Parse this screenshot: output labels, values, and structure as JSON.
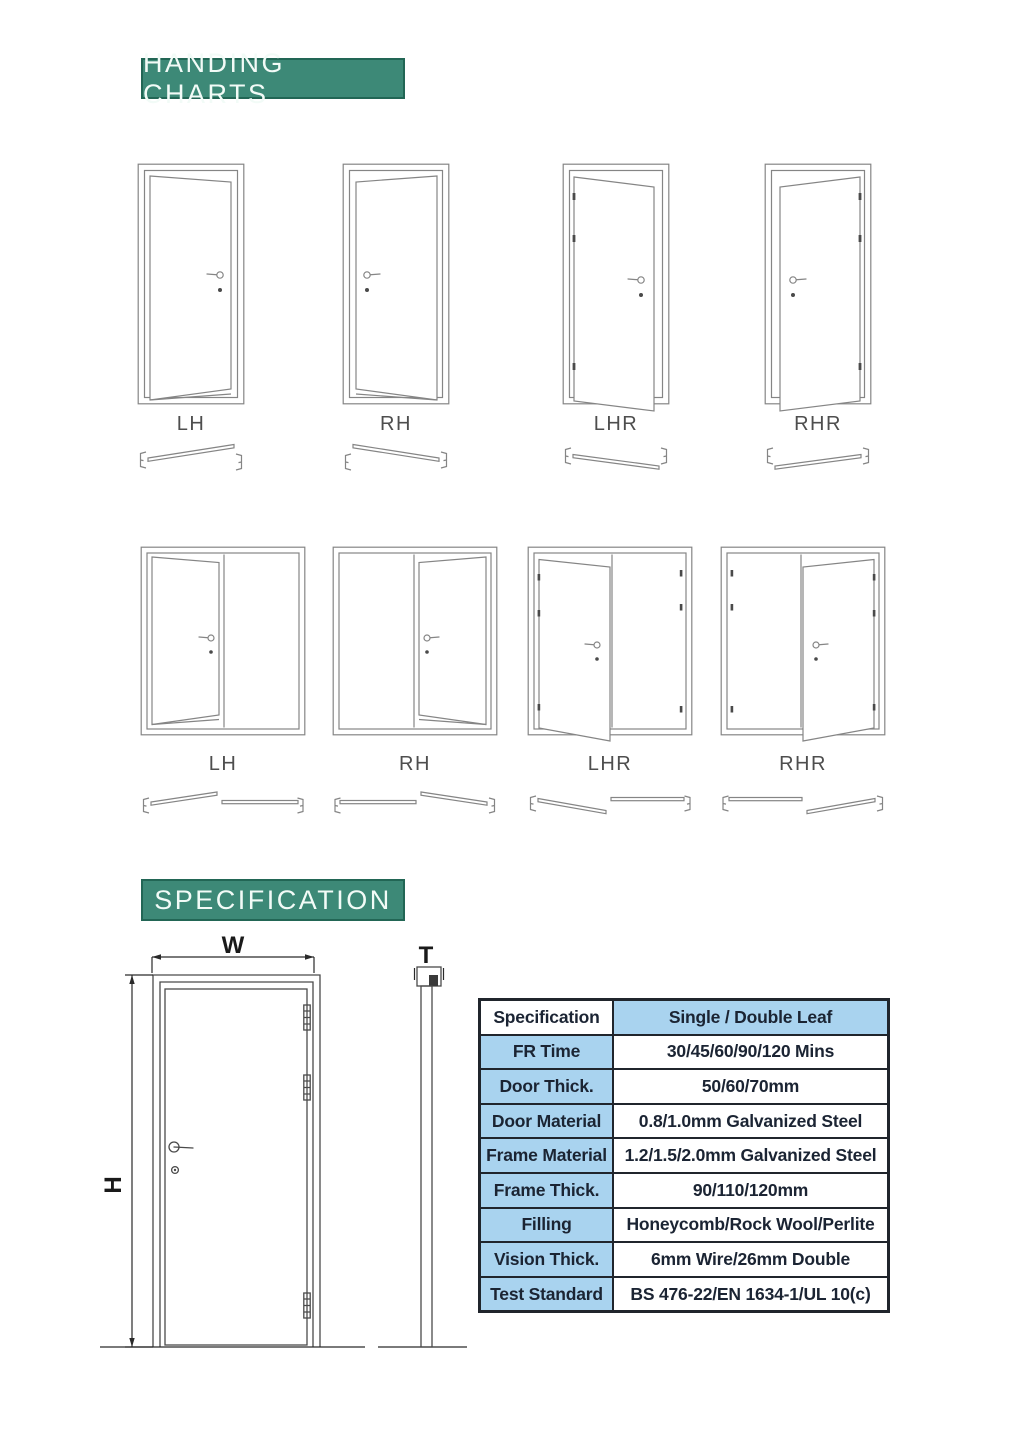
{
  "colors": {
    "banner_bg": "#3d8977",
    "banner_border": "#226655",
    "banner_text": "#f2fbf7",
    "table_blue": "#a9d3ef",
    "table_border": "#20252c",
    "table_text": "#1b2433",
    "line": "#858585",
    "line_dark": "#4a4a4a",
    "label_text": "#4e4e4e",
    "dim_text": "#1a1a1a"
  },
  "handing": {
    "title": "HANDING CHARTS",
    "single_doors": [
      {
        "label": "LH"
      },
      {
        "label": "RH"
      },
      {
        "label": "LHR"
      },
      {
        "label": "RHR"
      }
    ],
    "double_doors": [
      {
        "label": "LH"
      },
      {
        "label": "RH"
      },
      {
        "label": "LHR"
      },
      {
        "label": "RHR"
      }
    ]
  },
  "specification": {
    "title": "SPECIFICATION",
    "dimension_labels": {
      "width": "W",
      "height": "H",
      "thickness": "T"
    },
    "table": {
      "rows": [
        {
          "label": "Specification",
          "value": "Single / Double Leaf"
        },
        {
          "label": "FR Time",
          "value": "30/45/60/90/120 Mins"
        },
        {
          "label": "Door Thick.",
          "value": "50/60/70mm"
        },
        {
          "label": "Door Material",
          "value": "0.8/1.0mm Galvanized Steel"
        },
        {
          "label": "Frame Material",
          "value": "1.2/1.5/2.0mm Galvanized Steel"
        },
        {
          "label": "Frame Thick.",
          "value": "90/110/120mm"
        },
        {
          "label": "Filling",
          "value": "Honeycomb/Rock Wool/Perlite"
        },
        {
          "label": "Vision Thick.",
          "value": "6mm Wire/26mm Double"
        },
        {
          "label": "Test Standard",
          "value": "BS 476-22/EN 1634-1/UL 10(c)"
        }
      ]
    }
  }
}
